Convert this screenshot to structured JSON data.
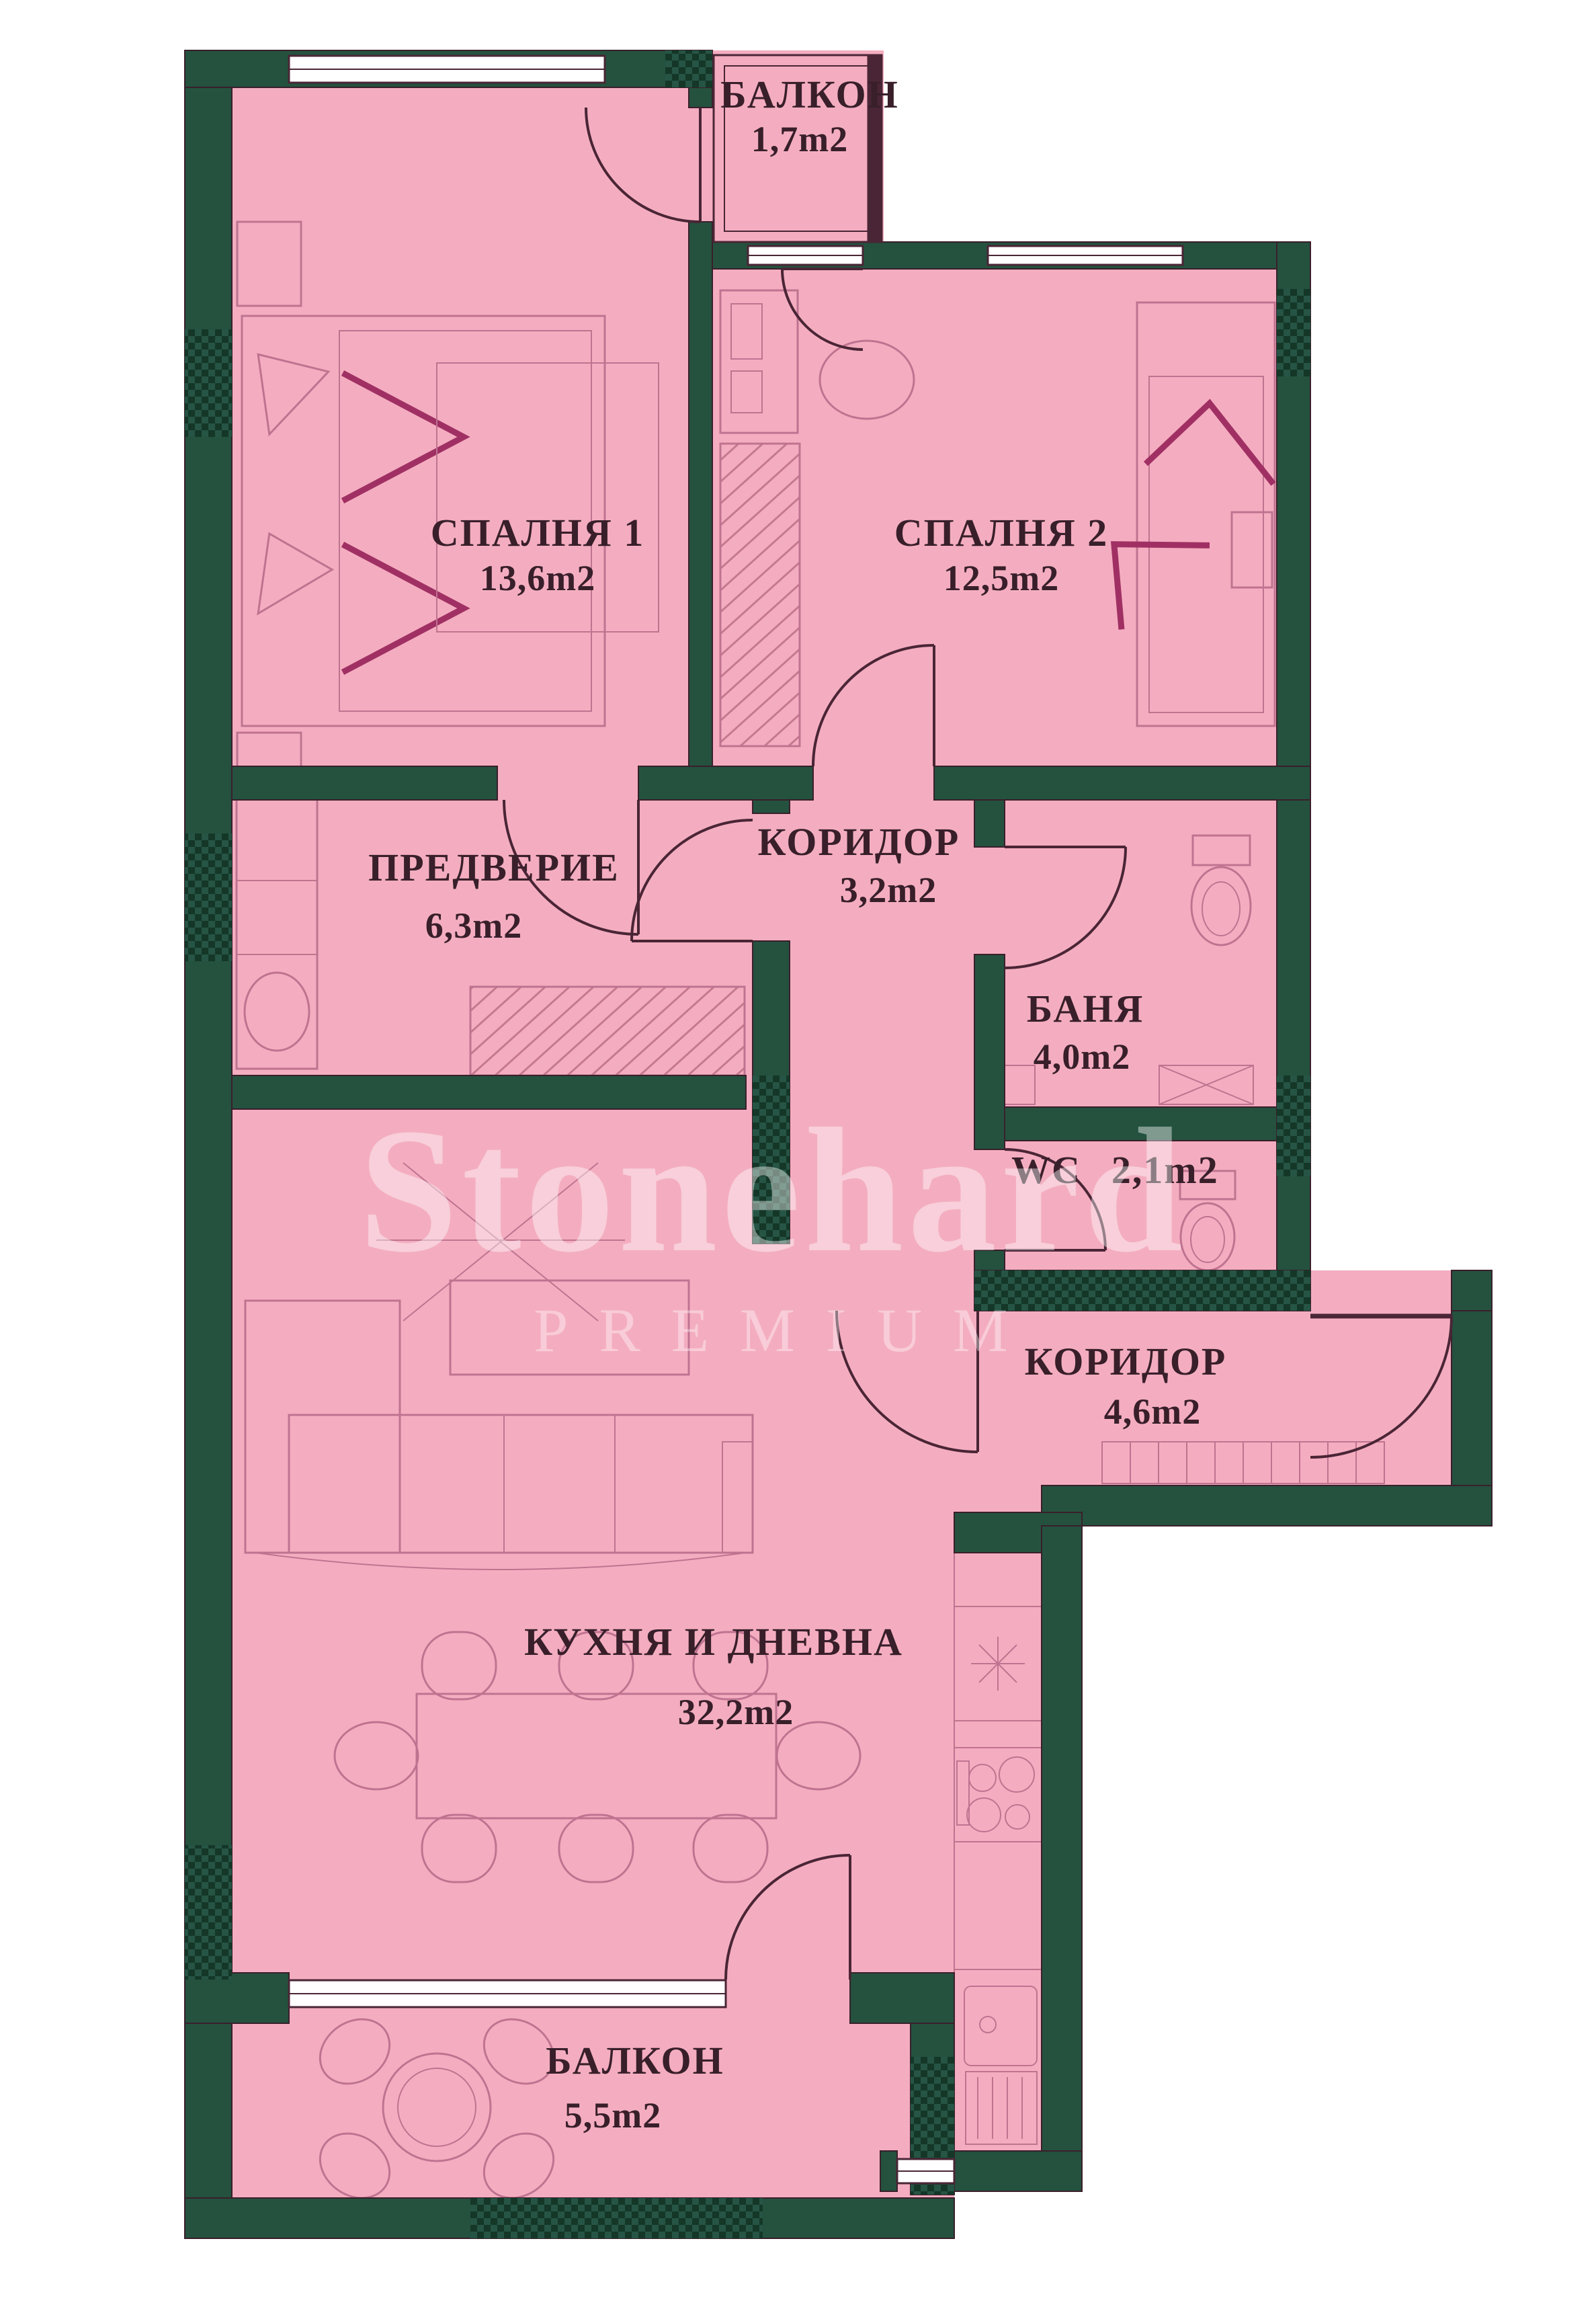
{
  "plan": {
    "title": "Apartment floor plan",
    "watermark": {
      "line1": "Stonehard",
      "line2": "PREMIUM"
    },
    "colors": {
      "room_fill": "#f4adc0",
      "wall": "#24523f",
      "wall_dark": "#143728",
      "outline": "#4a2535",
      "furniture_line": "#bf7390",
      "fold_accent": "#a03064",
      "label_text": "#381f2a"
    },
    "rooms": [
      {
        "id": "balcony-top",
        "name": "БАЛКОН",
        "area": "1,7m2"
      },
      {
        "id": "bedroom-1",
        "name": "СПАЛНЯ 1",
        "area": "13,6m2"
      },
      {
        "id": "bedroom-2",
        "name": "СПАЛНЯ 2",
        "area": "12,5m2"
      },
      {
        "id": "anteroom",
        "name": "ПРЕДВЕРИЕ",
        "area": "6,3m2"
      },
      {
        "id": "corridor-upper",
        "name": "КОРИДОР",
        "area": "3,2m2"
      },
      {
        "id": "bathroom",
        "name": "БАНЯ",
        "area": "4,0m2"
      },
      {
        "id": "wc",
        "name": "WC",
        "area": "2,1m2"
      },
      {
        "id": "corridor-entry",
        "name": "КОРИДОР",
        "area": "4,6m2"
      },
      {
        "id": "kitchen-living",
        "name": "КУХНЯ И ДНЕВНА",
        "area": "32,2m2"
      },
      {
        "id": "balcony-bottom",
        "name": "БАЛКОН",
        "area": "5,5m2"
      }
    ]
  }
}
